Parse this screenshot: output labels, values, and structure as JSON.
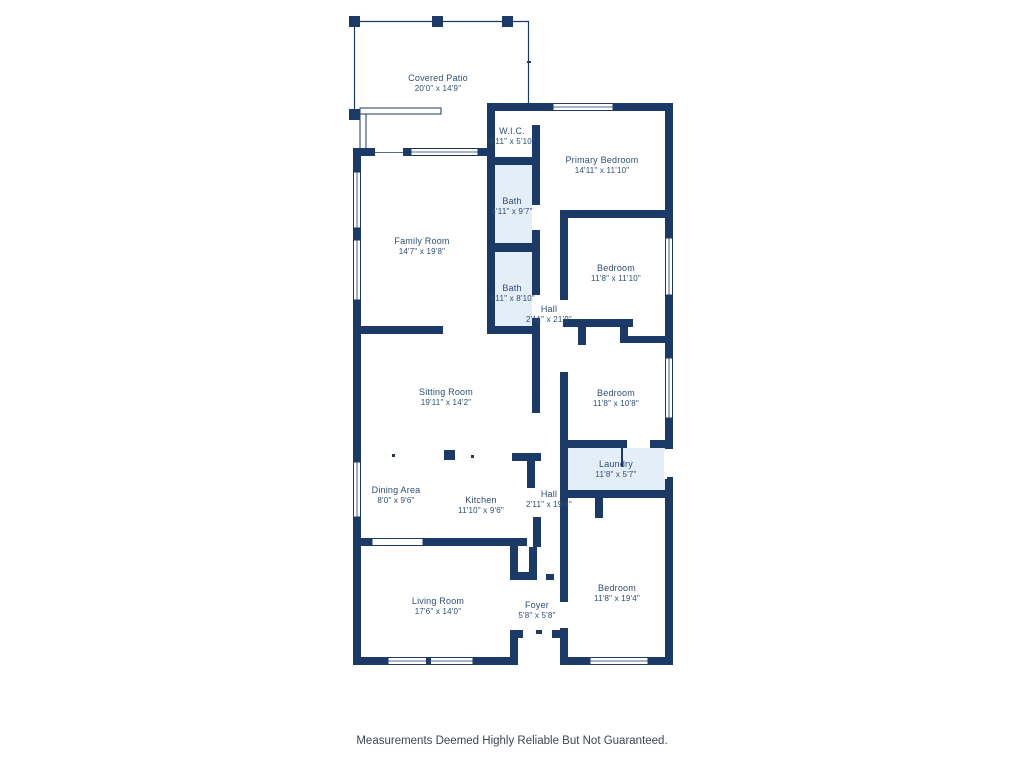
{
  "colors": {
    "wall": "#1b3a67",
    "room_fill": "#e3eef9",
    "label_text": "#2e4d74",
    "disclaimer_text": "#3d4653"
  },
  "rooms": [
    {
      "id": "covered-patio",
      "name": "Covered Patio",
      "dims": "20'0\" x 14'9\""
    },
    {
      "id": "wic",
      "name": "W.I.C.",
      "dims": "4'11\" x 5'10\""
    },
    {
      "id": "primary-bedroom",
      "name": "Primary Bedroom",
      "dims": "14'11\" x 11'10\""
    },
    {
      "id": "bath-upper",
      "name": "Bath",
      "dims": "4'11\" x 9'7\""
    },
    {
      "id": "family-room",
      "name": "Family Room",
      "dims": "14'7\" x 19'8\""
    },
    {
      "id": "bedroom-2",
      "name": "Bedroom",
      "dims": "11'8\" x 11'10\""
    },
    {
      "id": "bath-lower",
      "name": "Bath",
      "dims": "4'11\" x 8'10\""
    },
    {
      "id": "hall-upper",
      "name": "Hall",
      "dims": "2'11\" x 21'9\""
    },
    {
      "id": "sitting-room",
      "name": "Sitting Room",
      "dims": "19'11\" x 14'2\""
    },
    {
      "id": "bedroom-3",
      "name": "Bedroom",
      "dims": "11'8\" x 10'8\""
    },
    {
      "id": "laundry",
      "name": "Laundry",
      "dims": "11'8\" x 5'7\""
    },
    {
      "id": "dining-area",
      "name": "Dining Area",
      "dims": "8'0\" x 9'6\""
    },
    {
      "id": "kitchen",
      "name": "Kitchen",
      "dims": "11'10\" x 9'6\""
    },
    {
      "id": "hall-lower",
      "name": "Hall",
      "dims": "2'11\" x 19'4\""
    },
    {
      "id": "living-room",
      "name": "Living Room",
      "dims": "17'6\" x 14'0\""
    },
    {
      "id": "foyer",
      "name": "Foyer",
      "dims": "5'8\" x 5'8\""
    },
    {
      "id": "bedroom-4",
      "name": "Bedroom",
      "dims": "11'8\" x 19'4\""
    }
  ],
  "footer": {
    "disclaimer": "Measurements Deemed Highly Reliable But Not Guaranteed."
  }
}
